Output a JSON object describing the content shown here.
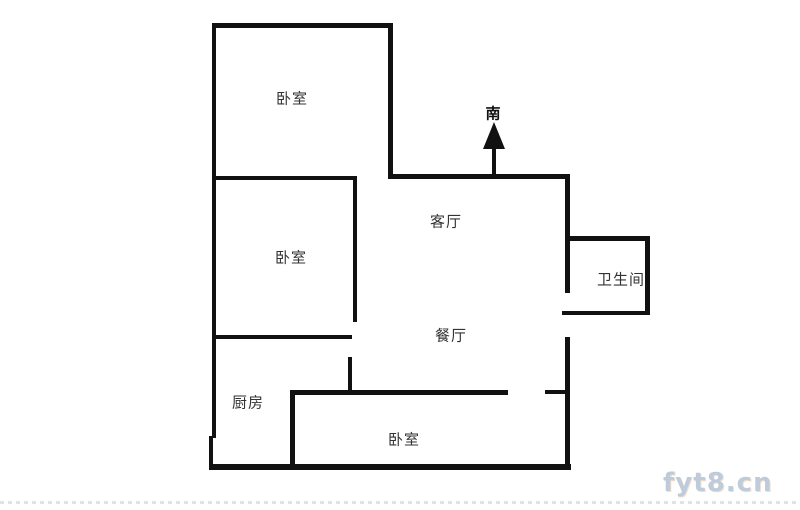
{
  "colors": {
    "background": "#ffffff",
    "wall": "#111111",
    "label": "#333333",
    "watermark": "#a9bacf",
    "watermark_accent": "#c8843c",
    "edge_dots": "#dcdcdc"
  },
  "floorplan": {
    "rooms": {
      "bedroom_top": {
        "label": "卧室"
      },
      "bedroom_middle": {
        "label": "卧室"
      },
      "bedroom_bottom": {
        "label": "卧室"
      },
      "living_room": {
        "label": "客厅"
      },
      "dining_room": {
        "label": "餐厅"
      },
      "bathroom": {
        "label": "卫生间"
      },
      "kitchen": {
        "label": "厨房"
      }
    },
    "compass": {
      "direction_label": "南"
    }
  },
  "watermark": {
    "text": "fyt8.cn"
  }
}
